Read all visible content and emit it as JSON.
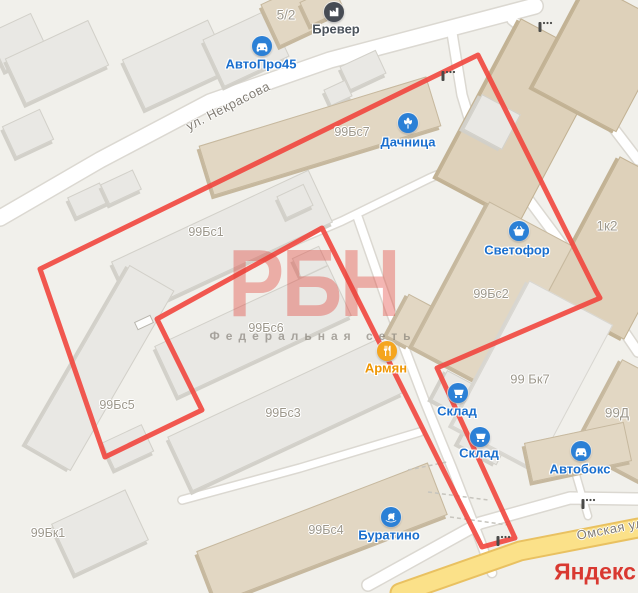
{
  "map": {
    "background": "#f1f0eb",
    "watermark": {
      "title": "РБН",
      "subtitle": "Федеральная сеть"
    },
    "logo": "Яндекс",
    "street_labels": [
      {
        "text": "ул. Некрасова",
        "x": 228,
        "y": 106,
        "rot": -27
      },
      {
        "text": "Омская ул",
        "x": 610,
        "y": 529,
        "rot": -11
      }
    ],
    "area_labels": [
      {
        "text": "5/2",
        "x": 286,
        "y": 15,
        "size": 13.5
      },
      {
        "text": "99Бс7",
        "x": 352,
        "y": 132,
        "size": 12.5
      },
      {
        "text": "99Бс1",
        "x": 206,
        "y": 232,
        "size": 12.5
      },
      {
        "text": "1к2",
        "x": 607,
        "y": 226,
        "size": 13.5
      },
      {
        "text": "99Бс2",
        "x": 491,
        "y": 294,
        "size": 12.5
      },
      {
        "text": "99Бс6",
        "x": 266,
        "y": 328,
        "size": 12.5
      },
      {
        "text": "99 Бк7",
        "x": 530,
        "y": 379,
        "size": 13
      },
      {
        "text": "99Д",
        "x": 617,
        "y": 413,
        "size": 13.5
      },
      {
        "text": "99Бс5",
        "x": 117,
        "y": 405,
        "size": 12.5
      },
      {
        "text": "99Бс3",
        "x": 283,
        "y": 413,
        "size": 12.5
      },
      {
        "text": "99Бк1",
        "x": 48,
        "y": 533,
        "size": 12.5
      },
      {
        "text": "99Бс4",
        "x": 326,
        "y": 530,
        "size": 12.5
      }
    ],
    "pois": [
      {
        "name": "АвтоПро45",
        "icon": "car-icon",
        "x": 262,
        "y": 46,
        "lx": 261,
        "ly": 64,
        "color": "#2b80d6",
        "label_color": "#1a6fce"
      },
      {
        "name": "Бревер",
        "icon": "factory-icon",
        "x": 334,
        "y": 12,
        "lx": 336,
        "ly": 29,
        "color": "#474c54",
        "label_color": "#4c545c"
      },
      {
        "name": "Дачница",
        "icon": "flower-icon",
        "x": 408,
        "y": 123,
        "lx": 408,
        "ly": 142,
        "color": "#2b80d6",
        "label_color": "#1a6fce"
      },
      {
        "name": "Светофор",
        "icon": "basket-icon",
        "x": 519,
        "y": 231,
        "lx": 517,
        "ly": 250,
        "color": "#2b80d6",
        "label_color": "#1a6fce"
      },
      {
        "name": "Армян",
        "icon": "cutlery-icon",
        "x": 387,
        "y": 351,
        "lx": 386,
        "ly": 368,
        "color": "#f5a51d",
        "label_color": "#ee9502"
      },
      {
        "name": "Склад",
        "icon": "cart-icon",
        "x": 458,
        "y": 393,
        "lx": 457,
        "ly": 411,
        "color": "#2b80d6",
        "label_color": "#1a6fce"
      },
      {
        "name": "Склад",
        "icon": "cart-icon",
        "x": 480,
        "y": 437,
        "lx": 479,
        "ly": 453,
        "color": "#2b80d6",
        "label_color": "#1a6fce"
      },
      {
        "name": "Автобокс",
        "icon": "car-icon",
        "x": 581,
        "y": 451,
        "lx": 580,
        "ly": 469,
        "color": "#2b80d6",
        "label_color": "#1a6fce"
      },
      {
        "name": "Буратино",
        "icon": "rocking-horse-icon",
        "x": 391,
        "y": 517,
        "lx": 389,
        "ly": 535,
        "color": "#2b80d6",
        "label_color": "#1a6fce"
      }
    ],
    "polygon": {
      "color": "#f1463e",
      "width": 5,
      "points": [
        [
          40,
          269
        ],
        [
          478,
          55
        ],
        [
          596,
          291
        ],
        [
          600,
          298
        ],
        [
          437,
          368
        ],
        [
          515,
          538
        ],
        [
          482,
          547
        ],
        [
          322,
          228
        ],
        [
          157,
          319
        ],
        [
          202,
          410
        ],
        [
          105,
          457
        ]
      ]
    },
    "roads": [
      {
        "name": "nekrasova-street",
        "kind": "major",
        "width": 15,
        "points": [
          [
            0,
            218
          ],
          [
            100,
            160
          ],
          [
            210,
            102
          ],
          [
            330,
            60
          ],
          [
            455,
            27
          ],
          [
            535,
            6
          ]
        ]
      },
      {
        "name": "east-side-road",
        "kind": "minor",
        "width": 9,
        "points": [
          [
            452,
            33
          ],
          [
            462,
            95
          ],
          [
            478,
            148
          ],
          [
            523,
            192
          ],
          [
            596,
            290
          ],
          [
            638,
            352
          ]
        ]
      },
      {
        "name": "northeast-road",
        "kind": "minor",
        "width": 9,
        "points": [
          [
            512,
            20
          ],
          [
            560,
            58
          ],
          [
            638,
            160
          ]
        ]
      },
      {
        "name": "inner-road-upper",
        "kind": "minor",
        "width": 7,
        "points": [
          [
            262,
            255
          ],
          [
            342,
            221
          ],
          [
            430,
            178
          ],
          [
            492,
            152
          ]
        ]
      },
      {
        "name": "corridor-road",
        "kind": "minor",
        "width": 8,
        "points": [
          [
            358,
            218
          ],
          [
            390,
            310
          ],
          [
            425,
            402
          ],
          [
            452,
            468
          ],
          [
            480,
            540
          ],
          [
            492,
            573
          ]
        ]
      },
      {
        "name": "inner-road-lower",
        "kind": "minor",
        "width": 7,
        "points": [
          [
            182,
            500
          ],
          [
            300,
            468
          ],
          [
            420,
            432
          ]
        ]
      },
      {
        "name": "omskaya-service",
        "kind": "minor",
        "width": 11,
        "points": [
          [
            368,
            585
          ],
          [
            480,
            523
          ],
          [
            570,
            498
          ],
          [
            638,
            499
          ]
        ]
      },
      {
        "name": "access-road",
        "kind": "minor",
        "width": 6,
        "points": [
          [
            574,
            468
          ],
          [
            588,
            516
          ]
        ]
      },
      {
        "name": "omskaya-street",
        "kind": "yellow",
        "width": 17,
        "points": [
          [
            400,
            593
          ],
          [
            520,
            551
          ],
          [
            638,
            528
          ]
        ]
      }
    ],
    "fences": [
      [
        [
          408,
          470
        ],
        [
          447,
          462
        ]
      ],
      [
        [
          428,
          492
        ],
        [
          488,
          500
        ]
      ],
      [
        [
          450,
          517
        ],
        [
          508,
          525
        ]
      ]
    ],
    "barriers": [
      {
        "x": 443,
        "y": 76
      },
      {
        "x": 540,
        "y": 27
      },
      {
        "x": 498,
        "y": 541
      },
      {
        "x": 583,
        "y": 504
      }
    ],
    "gate": {
      "x": 143,
      "y": 322,
      "rot": -25
    },
    "palettes": {
      "gray": {
        "roof": "#e9e8e4",
        "side": "#d2d0c9"
      },
      "light": {
        "roof": "#eeedea",
        "side": "#d8d6d0"
      },
      "tan": {
        "roof": "#e2d7c3",
        "side": "#c6b89e"
      },
      "tan2": {
        "roof": "#ded1ba",
        "side": "#c2b294"
      }
    },
    "buildings": [
      {
        "cx": 18,
        "cy": 42,
        "w": 48,
        "h": 42,
        "rot": -25,
        "pal": "gray"
      },
      {
        "cx": 57,
        "cy": 62,
        "w": 92,
        "h": 50,
        "rot": -25,
        "pal": "gray"
      },
      {
        "cx": 28,
        "cy": 133,
        "w": 42,
        "h": 34,
        "rot": -25,
        "pal": "gray"
      },
      {
        "cx": 88,
        "cy": 200,
        "w": 36,
        "h": 22,
        "rot": -25,
        "pal": "gray"
      },
      {
        "cx": 121,
        "cy": 187,
        "w": 36,
        "h": 22,
        "rot": -25,
        "pal": "gray"
      },
      {
        "cx": 176,
        "cy": 64,
        "w": 95,
        "h": 55,
        "rot": -25,
        "pal": "gray"
      },
      {
        "cx": 246,
        "cy": 48,
        "w": 72,
        "h": 52,
        "rot": -25,
        "pal": "gray"
      },
      {
        "cx": 290,
        "cy": 16,
        "w": 44,
        "h": 46,
        "rot": -25,
        "pal": "tan"
      },
      {
        "cx": 322,
        "cy": 6,
        "w": 38,
        "h": 26,
        "rot": -25,
        "pal": "tan"
      },
      {
        "cx": 363,
        "cy": 70,
        "w": 40,
        "h": 26,
        "rot": -25,
        "pal": "gray"
      },
      {
        "cx": 338,
        "cy": 93,
        "w": 24,
        "h": 18,
        "rot": -25,
        "pal": "gray"
      },
      {
        "cx": 320,
        "cy": 136,
        "w": 238,
        "h": 52,
        "rot": -17,
        "pal": "tan"
      },
      {
        "cx": 222,
        "cy": 242,
        "w": 218,
        "h": 58,
        "rot": -25,
        "pal": "gray"
      },
      {
        "cx": 295,
        "cy": 201,
        "w": 30,
        "h": 24,
        "rot": -25,
        "pal": "gray"
      },
      {
        "cx": 310,
        "cy": 262,
        "w": 30,
        "h": 22,
        "rot": -25,
        "pal": "gray"
      },
      {
        "cx": 253,
        "cy": 331,
        "w": 192,
        "h": 56,
        "rot": -25,
        "pal": "gray"
      },
      {
        "cx": 100,
        "cy": 368,
        "w": 52,
        "h": 208,
        "rot": 30,
        "pal": "gray"
      },
      {
        "cx": 285,
        "cy": 415,
        "w": 232,
        "h": 60,
        "rot": -25,
        "pal": "gray"
      },
      {
        "cx": 128,
        "cy": 447,
        "w": 44,
        "h": 30,
        "rot": -25,
        "pal": "gray"
      },
      {
        "cx": 100,
        "cy": 532,
        "w": 82,
        "h": 56,
        "rot": -25,
        "pal": "gray"
      },
      {
        "cx": 322,
        "cy": 533,
        "w": 248,
        "h": 56,
        "rot": -21,
        "pal": "tan"
      },
      {
        "cx": 409,
        "cy": 321,
        "w": 26,
        "h": 48,
        "rot": 28,
        "pal": "tan"
      },
      {
        "cx": 520,
        "cy": 120,
        "w": 95,
        "h": 180,
        "rot": 28,
        "pal": "tan2"
      },
      {
        "cx": 602,
        "cy": 57,
        "w": 95,
        "h": 120,
        "rot": 28,
        "pal": "tan2"
      },
      {
        "cx": 492,
        "cy": 122,
        "w": 44,
        "h": 40,
        "rot": 28,
        "pal": "gray"
      },
      {
        "cx": 622,
        "cy": 248,
        "w": 90,
        "h": 160,
        "rot": 28,
        "pal": "tan2"
      },
      {
        "cx": 492,
        "cy": 296,
        "w": 95,
        "h": 165,
        "rot": 28,
        "pal": "tan"
      },
      {
        "cx": 456,
        "cy": 394,
        "w": 38,
        "h": 34,
        "rot": 28,
        "pal": "gray"
      },
      {
        "cx": 485,
        "cy": 440,
        "w": 44,
        "h": 34,
        "rot": 28,
        "pal": "gray"
      },
      {
        "cx": 532,
        "cy": 375,
        "w": 95,
        "h": 165,
        "rot": 28,
        "pal": "light"
      },
      {
        "cx": 634,
        "cy": 422,
        "w": 80,
        "h": 100,
        "rot": 28,
        "pal": "tan"
      },
      {
        "cx": 578,
        "cy": 452,
        "w": 102,
        "h": 40,
        "rot": -12,
        "pal": "tan"
      }
    ]
  }
}
